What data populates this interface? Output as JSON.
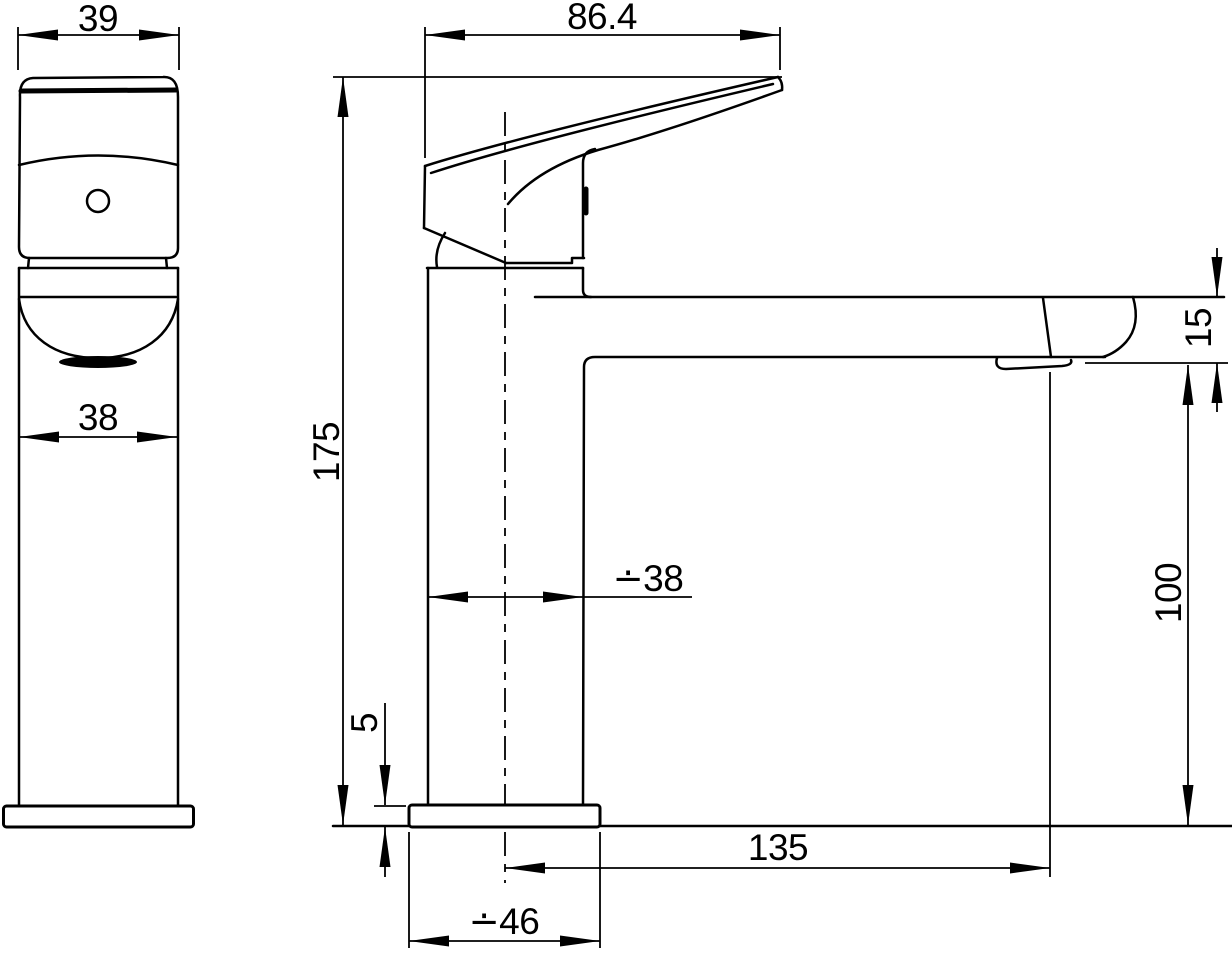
{
  "drawing": {
    "colors": {
      "line": "#000000",
      "background": "#ffffff"
    },
    "views": {
      "front_view": {
        "dimensions": {
          "handle_width": "39",
          "body_width": "38"
        }
      },
      "side_view": {
        "dimensions": {
          "handle_length": "86.4",
          "overall_height": "175",
          "body_diameter": "∸38",
          "spout_end_height": "15",
          "spout_underside_height": "100",
          "base_plate_thickness": "5",
          "spout_reach": "135",
          "base_diameter": "∸46"
        }
      }
    }
  }
}
